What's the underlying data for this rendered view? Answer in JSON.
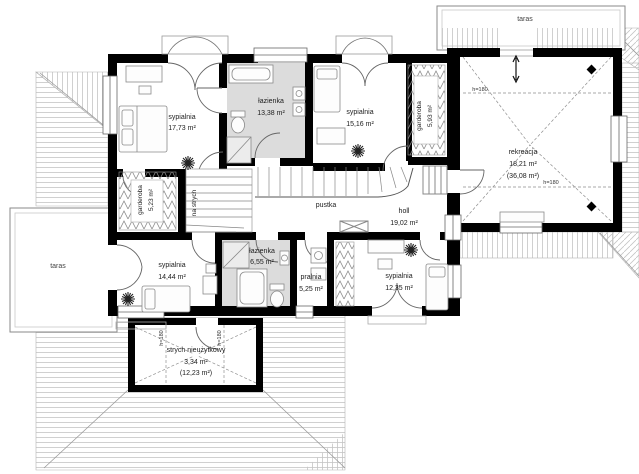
{
  "plan": {
    "type": "floor-plan",
    "colors": {
      "wall": "#000000",
      "bath_fill": "#dcdcdc",
      "roof_line": "#c4c4c4",
      "thin_line": "#8a8a8a"
    },
    "rooms": [
      {
        "id": "sypialnia-1",
        "name": "sypialnia",
        "area": "17,73 m²"
      },
      {
        "id": "lazienka-1",
        "name": "łazienka",
        "area": "13,38 m²"
      },
      {
        "id": "sypialnia-2",
        "name": "sypialnia",
        "area": "15,16 m²"
      },
      {
        "id": "garderoba-2",
        "name": "garderoba",
        "area": "5,93 m²"
      },
      {
        "id": "rekreacja",
        "name": "rekreacja",
        "area": "18,21 m²",
        "area2": "(36,08 m²)"
      },
      {
        "id": "garderoba-1",
        "name": "garderoba",
        "area": "5,23 m²"
      },
      {
        "id": "pustka",
        "name": "pustka"
      },
      {
        "id": "holl",
        "name": "holl",
        "area": "19,02 m²"
      },
      {
        "id": "sypialnia-3",
        "name": "sypialnia",
        "area": "14,44 m²"
      },
      {
        "id": "lazienka-2",
        "name": "łazienka",
        "area": "6,55 m²"
      },
      {
        "id": "pralnia",
        "name": "pralnia",
        "area": "5,25 m²"
      },
      {
        "id": "sypialnia-4",
        "name": "sypialnia",
        "area": "12,35 m²"
      },
      {
        "id": "strych",
        "name": "strych nieużytkowy",
        "area": "3,34 m²",
        "area2": "(12,23 m²)"
      }
    ],
    "annotations": {
      "height": "h=180",
      "stairs": "na strych",
      "terrace": "taras"
    }
  }
}
